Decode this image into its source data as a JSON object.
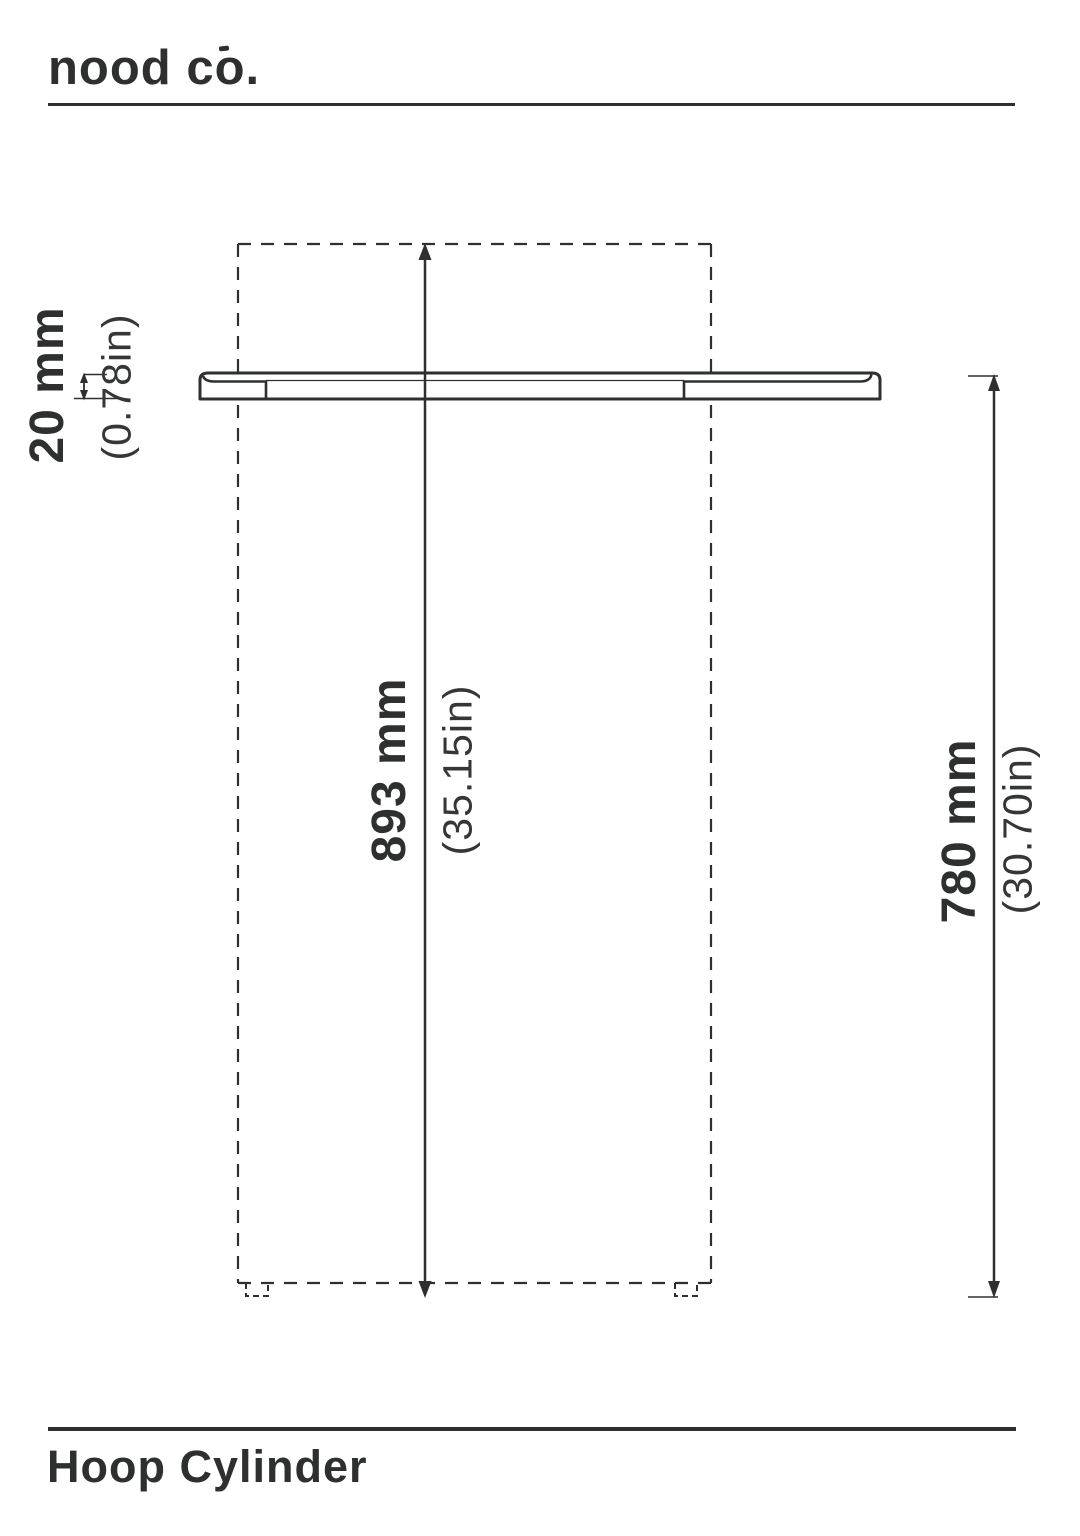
{
  "brand": {
    "name": "nood co."
  },
  "product": {
    "title": "Hoop Cylinder"
  },
  "dimensions": {
    "thickness": {
      "metric": "20 mm",
      "imperial": "(0.78in)"
    },
    "overall_height": {
      "metric": "893 mm",
      "imperial": "(35.15in)"
    },
    "rim_height": {
      "metric": "780 mm",
      "imperial": "(30.70in)"
    }
  },
  "colors": {
    "ink": "#2d302e",
    "background": "#ffffff"
  }
}
